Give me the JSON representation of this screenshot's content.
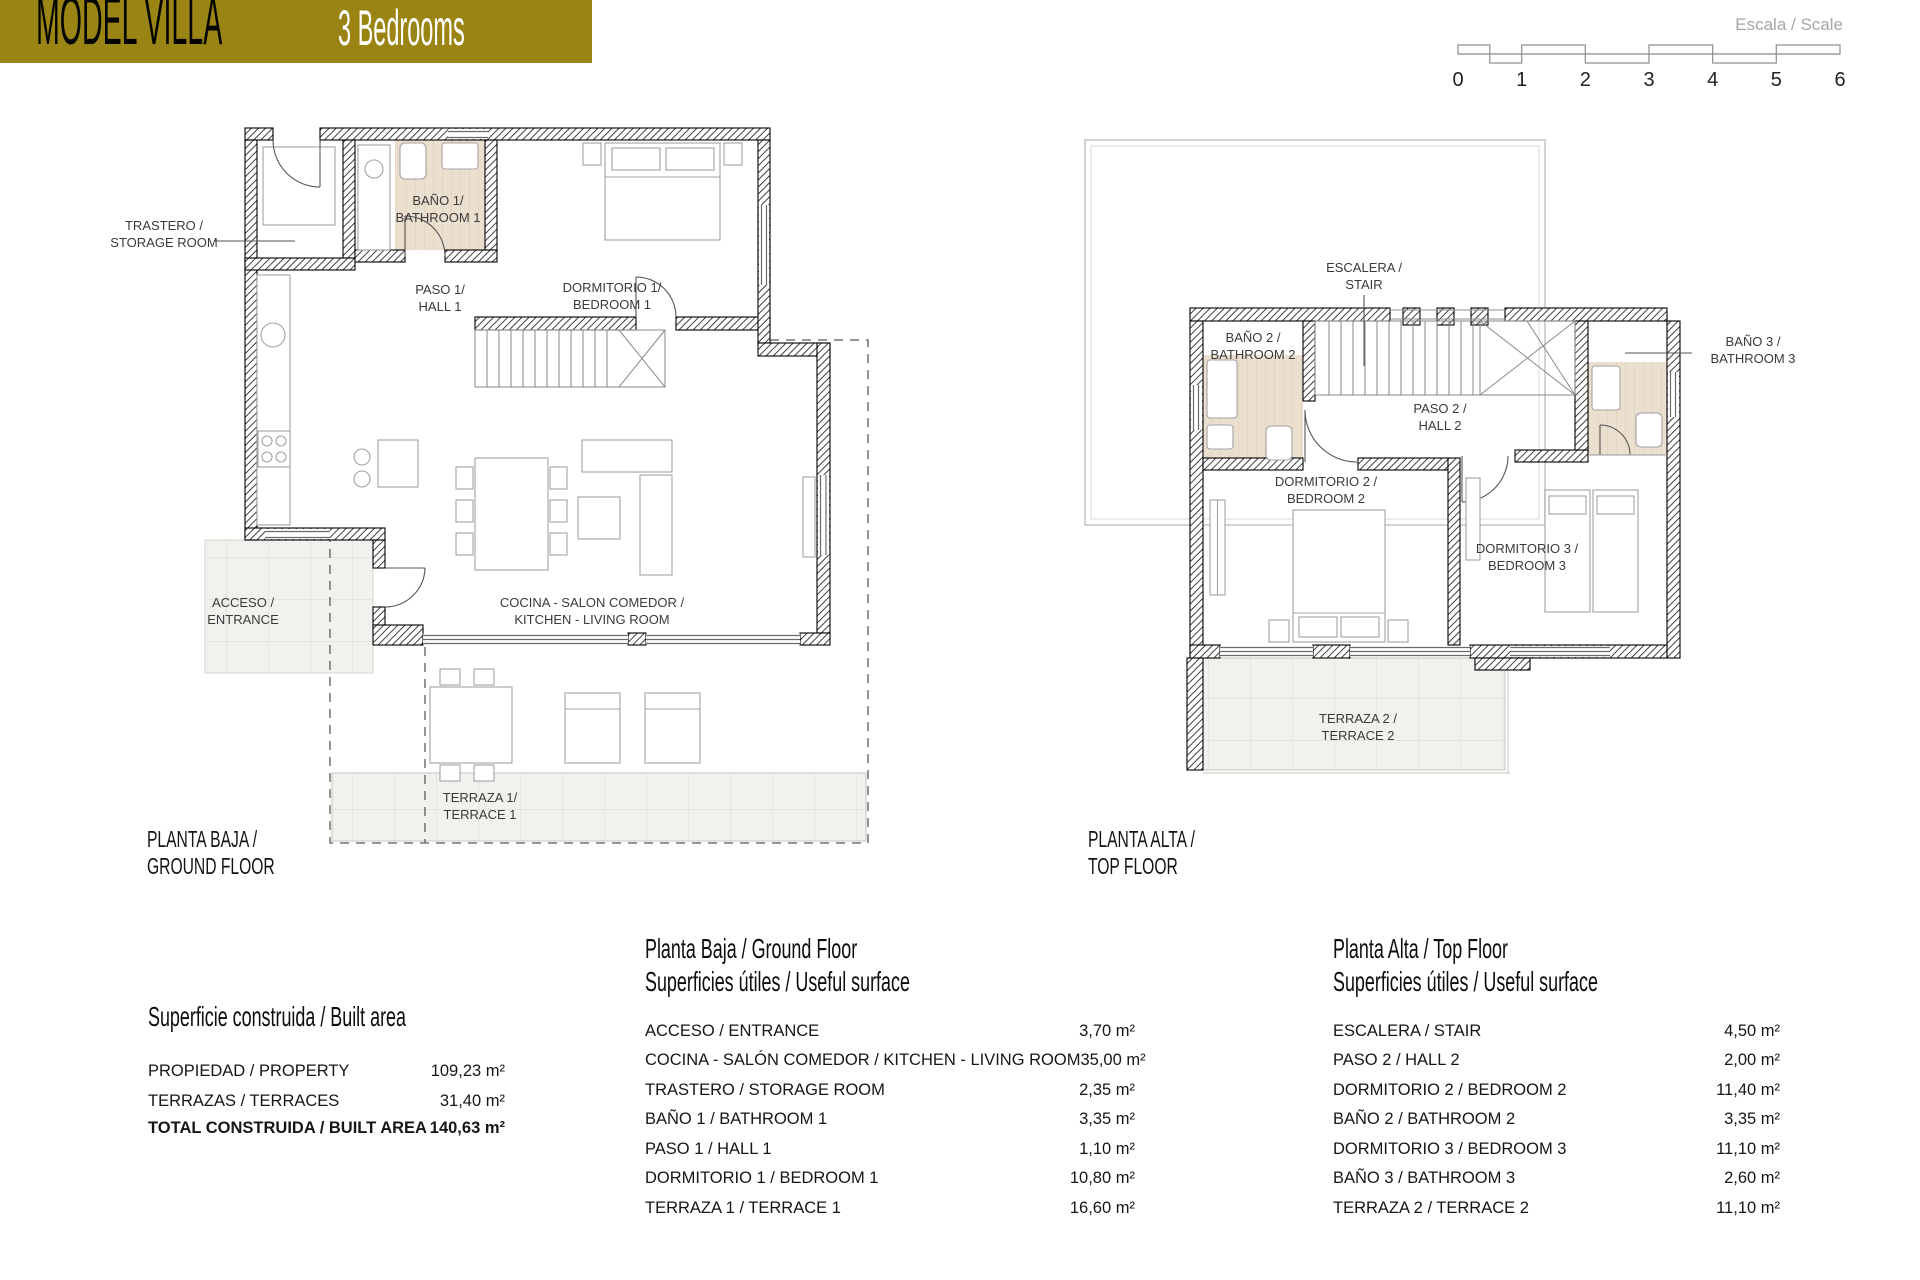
{
  "header": {
    "title": "MODEL VILLA",
    "subtitle": "3 Bedrooms"
  },
  "scale_bar": {
    "label": "Escala / Scale",
    "ticks": [
      "0",
      "1",
      "2",
      "3",
      "4",
      "5",
      "6"
    ]
  },
  "colors": {
    "brand_gold": "#9a8514",
    "bathroom_floor": "#ebdfd0",
    "terrace_tile": "#f1f1ee"
  },
  "ground_floor": {
    "caption_line1": "PLANTA BAJA /",
    "caption_line2": "GROUND FLOOR",
    "rooms": {
      "storage_line1": "TRASTERO /",
      "storage_line2": "STORAGE ROOM",
      "bath1_line1": "BAÑO 1/",
      "bath1_line2": "BATHROOM 1",
      "hall1_line1": "PASO 1/",
      "hall1_line2": "HALL 1",
      "bedroom1_line1": "DORMITORIO 1/",
      "bedroom1_line2": "BEDROOM 1",
      "entrance_line1": "ACCESO /",
      "entrance_line2": "ENTRANCE",
      "kitchen_line1": "COCINA - SALON COMEDOR /",
      "kitchen_line2": "KITCHEN - LIVING ROOM",
      "terrace1_line1": "TERRAZA 1/",
      "terrace1_line2": "TERRACE 1"
    }
  },
  "top_floor": {
    "caption_line1": "PLANTA ALTA /",
    "caption_line2": "TOP FLOOR",
    "rooms": {
      "stair_line1": "ESCALERA /",
      "stair_line2": "STAIR",
      "bath2_line1": "BAÑO 2 /",
      "bath2_line2": "BATHROOM 2",
      "bath3_line1": "BAÑO 3 /",
      "bath3_line2": "BATHROOM 3",
      "hall2_line1": "PASO 2 /",
      "hall2_line2": "HALL 2",
      "bedroom2_line1": "DORMITORIO 2 /",
      "bedroom2_line2": "BEDROOM 2",
      "bedroom3_line1": "DORMITORIO 3 /",
      "bedroom3_line2": "BEDROOM 3",
      "terrace2_line1": "TERRAZA 2 /",
      "terrace2_line2": "TERRACE 2"
    }
  },
  "built_area_table": {
    "title": "Superficie construida / Built area",
    "rows": [
      {
        "label": "PROPIEDAD / PROPERTY",
        "value": "109,23 m²"
      },
      {
        "label": "TERRAZAS / TERRACES",
        "value": "31,40 m²"
      },
      {
        "label": "TOTAL CONSTRUIDA / BUILT AREA",
        "value": "140,63 m²"
      }
    ]
  },
  "ground_floor_table": {
    "title_line1": "Planta Baja / Ground Floor",
    "title_line2": "Superficies útiles / Useful surface",
    "rows": [
      {
        "label": "ACCESO / ENTRANCE",
        "value": "3,70 m²"
      },
      {
        "label": "COCINA - SALÓN COMEDOR / KITCHEN - LIVING ROOM",
        "value": "35,00 m²"
      },
      {
        "label": "TRASTERO / STORAGE ROOM",
        "value": "2,35 m²"
      },
      {
        "label": "BAÑO 1 / BATHROOM 1",
        "value": "3,35 m²"
      },
      {
        "label": "PASO 1 / HALL 1",
        "value": "1,10 m²"
      },
      {
        "label": "DORMITORIO 1 / BEDROOM 1",
        "value": "10,80 m²"
      },
      {
        "label": "TERRAZA 1 / TERRACE 1",
        "value": "16,60 m²"
      }
    ]
  },
  "top_floor_table": {
    "title_line1": "Planta Alta / Top Floor",
    "title_line2": "Superficies útiles / Useful surface",
    "rows": [
      {
        "label": "ESCALERA / STAIR",
        "value": "4,50 m²"
      },
      {
        "label": "PASO 2 / HALL 2",
        "value": "2,00 m²"
      },
      {
        "label": "DORMITORIO 2 / BEDROOM 2",
        "value": "11,40 m²"
      },
      {
        "label": "BAÑO 2 / BATHROOM 2",
        "value": "3,35 m²"
      },
      {
        "label": "DORMITORIO 3 / BEDROOM 3",
        "value": "11,10 m²"
      },
      {
        "label": "BAÑO 3 / BATHROOM 3",
        "value": "2,60 m²"
      },
      {
        "label": "TERRAZA  2 / TERRACE  2",
        "value": "11,10 m²"
      }
    ]
  }
}
